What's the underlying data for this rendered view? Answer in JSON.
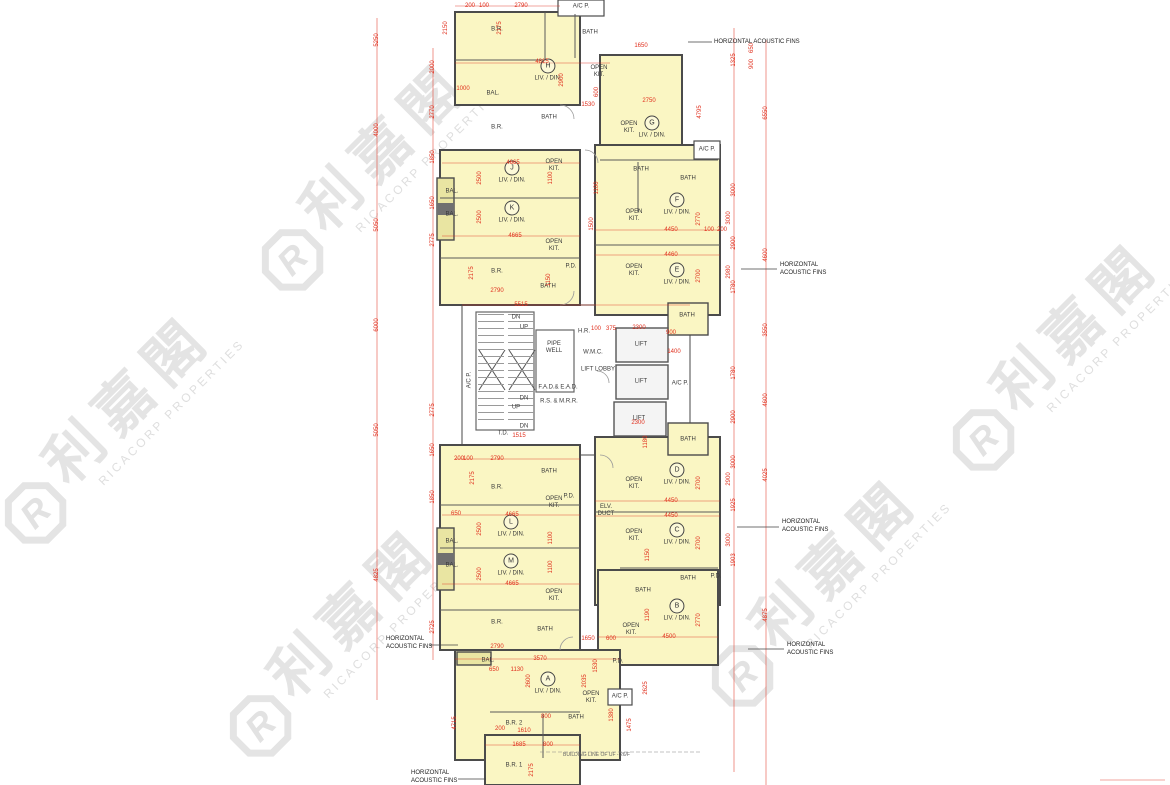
{
  "watermark": {
    "chinese": "利嘉閣",
    "latin": "RICACORP PROPERTIES",
    "logo_letter": "R",
    "color": "#E3E3E3",
    "instances": [
      {
        "x": 372,
        "y": 172
      },
      {
        "x": 1063,
        "y": 352
      },
      {
        "x": 115,
        "y": 425
      },
      {
        "x": 340,
        "y": 638
      },
      {
        "x": 822,
        "y": 588
      }
    ]
  },
  "plan": {
    "colors": {
      "unit_fill": "#FAF6C3",
      "balcony_fill": "#E9E5A2",
      "wall": "#4B4B4B",
      "dimension_red": "#E0301E",
      "watermark_gray": "#E3E3E3"
    },
    "unit_sub": "LIV. / DIN.",
    "acoustic_label": "HORIZONTAL ACOUSTIC FINS",
    "building_line_note": "BUILDING LINE OF UF - 26/F",
    "units": [
      {
        "id": "H",
        "x": 548,
        "y": 70
      },
      {
        "id": "G",
        "x": 652,
        "y": 127
      },
      {
        "id": "J",
        "x": 512,
        "y": 172
      },
      {
        "id": "K",
        "x": 512,
        "y": 212
      },
      {
        "id": "F",
        "x": 677,
        "y": 204
      },
      {
        "id": "E",
        "x": 677,
        "y": 274
      },
      {
        "id": "L",
        "x": 511,
        "y": 526
      },
      {
        "id": "M",
        "x": 511,
        "y": 565
      },
      {
        "id": "D",
        "x": 677,
        "y": 474
      },
      {
        "id": "C",
        "x": 677,
        "y": 534
      },
      {
        "id": "B",
        "x": 677,
        "y": 610
      },
      {
        "id": "A",
        "x": 548,
        "y": 683
      }
    ],
    "rooms": [
      {
        "t": "B.R.",
        "x": 497,
        "y": 30
      },
      {
        "t": "BATH",
        "x": 590,
        "y": 33
      },
      {
        "t": "A/C P.",
        "x": 581,
        "y": 7
      },
      {
        "t": "OPEN KIT.",
        "x": 599,
        "y": 72,
        "w": 24
      },
      {
        "t": "BAL.",
        "x": 493,
        "y": 94
      },
      {
        "t": "OPEN KIT.",
        "x": 629,
        "y": 128,
        "w": 24
      },
      {
        "t": "B.R.",
        "x": 497,
        "y": 128
      },
      {
        "t": "BATH",
        "x": 549,
        "y": 118
      },
      {
        "t": "BATH",
        "x": 641,
        "y": 170
      },
      {
        "t": "BATH",
        "x": 688,
        "y": 179
      },
      {
        "t": "A/C P.",
        "x": 707,
        "y": 150
      },
      {
        "t": "OPEN KIT.",
        "x": 554,
        "y": 166,
        "w": 24
      },
      {
        "t": "BAL.",
        "x": 452,
        "y": 192
      },
      {
        "t": "BAL.",
        "x": 452,
        "y": 215
      },
      {
        "t": "OPEN KIT.",
        "x": 554,
        "y": 246,
        "w": 24
      },
      {
        "t": "B.R.",
        "x": 497,
        "y": 272
      },
      {
        "t": "BATH",
        "x": 548,
        "y": 287
      },
      {
        "t": "P.D.",
        "x": 571,
        "y": 267
      },
      {
        "t": "OPEN KIT.",
        "x": 634,
        "y": 216,
        "w": 24
      },
      {
        "t": "OPEN KIT.",
        "x": 634,
        "y": 271,
        "w": 24
      },
      {
        "t": "BATH",
        "x": 687,
        "y": 316
      },
      {
        "t": "A/C P.",
        "x": 470,
        "y": 380,
        "r": 1
      },
      {
        "t": "DN",
        "x": 516,
        "y": 318
      },
      {
        "t": "UP",
        "x": 524,
        "y": 328
      },
      {
        "t": "PIPE WELL",
        "x": 554,
        "y": 348,
        "w": 26
      },
      {
        "t": "H.R.",
        "x": 584,
        "y": 332
      },
      {
        "t": "W.M.C.",
        "x": 593,
        "y": 353
      },
      {
        "t": "LIFT LOBBY",
        "x": 598,
        "y": 370
      },
      {
        "t": "F.A.D.& E.A.D.",
        "x": 558,
        "y": 388
      },
      {
        "t": "R.S. & M.R.R.",
        "x": 559,
        "y": 402
      },
      {
        "t": "DN",
        "x": 524,
        "y": 399
      },
      {
        "t": "UP",
        "x": 516,
        "y": 408
      },
      {
        "t": "DN",
        "x": 524,
        "y": 427
      },
      {
        "t": "T.D.",
        "x": 503,
        "y": 434
      },
      {
        "t": "LIFT",
        "x": 641,
        "y": 345
      },
      {
        "t": "LIFT",
        "x": 641,
        "y": 382
      },
      {
        "t": "LIFT",
        "x": 639,
        "y": 419
      },
      {
        "t": "A/C P.",
        "x": 680,
        "y": 384
      },
      {
        "t": "BATH",
        "x": 688,
        "y": 440
      },
      {
        "t": "OPEN KIT.",
        "x": 634,
        "y": 484,
        "w": 24
      },
      {
        "t": "ELV. DUCT",
        "x": 606,
        "y": 511,
        "w": 22
      },
      {
        "t": "B.R.",
        "x": 497,
        "y": 488
      },
      {
        "t": "BATH",
        "x": 549,
        "y": 472
      },
      {
        "t": "OPEN KIT.",
        "x": 554,
        "y": 503,
        "w": 24
      },
      {
        "t": "P.D.",
        "x": 569,
        "y": 497
      },
      {
        "t": "BAL.",
        "x": 452,
        "y": 542
      },
      {
        "t": "BAL.",
        "x": 452,
        "y": 566
      },
      {
        "t": "OPEN KIT.",
        "x": 554,
        "y": 596,
        "w": 24
      },
      {
        "t": "B.R.",
        "x": 497,
        "y": 623
      },
      {
        "t": "BATH",
        "x": 545,
        "y": 630
      },
      {
        "t": "OPEN KIT.",
        "x": 634,
        "y": 536,
        "w": 24
      },
      {
        "t": "BATH",
        "x": 688,
        "y": 579
      },
      {
        "t": "BATH",
        "x": 643,
        "y": 591
      },
      {
        "t": "P.D.",
        "x": 716,
        "y": 577
      },
      {
        "t": "OPEN KIT.",
        "x": 631,
        "y": 630,
        "w": 24
      },
      {
        "t": "P.D.",
        "x": 618,
        "y": 662
      },
      {
        "t": "BAL.",
        "x": 488,
        "y": 661
      },
      {
        "t": "OPEN KIT.",
        "x": 591,
        "y": 698,
        "w": 24
      },
      {
        "t": "A/C P.",
        "x": 620,
        "y": 697
      },
      {
        "t": "BATH",
        "x": 576,
        "y": 718
      },
      {
        "t": "B.R. 2",
        "x": 514,
        "y": 724
      },
      {
        "t": "B.R. 1",
        "x": 514,
        "y": 766
      }
    ],
    "annotations": [
      {
        "x": 714,
        "y": 39,
        "cls": "one"
      },
      {
        "x": 780,
        "y": 262
      },
      {
        "x": 782,
        "y": 519
      },
      {
        "x": 787,
        "y": 642
      },
      {
        "x": 386,
        "y": 636
      },
      {
        "x": 411,
        "y": 770
      }
    ],
    "dims": [
      {
        "t": "200",
        "x": 470,
        "y": 6
      },
      {
        "t": "100",
        "x": 484,
        "y": 6
      },
      {
        "t": "2790",
        "x": 521,
        "y": 6
      },
      {
        "t": "2150",
        "x": 446,
        "y": 28,
        "r": 1
      },
      {
        "t": "2175",
        "x": 500,
        "y": 28,
        "r": 1
      },
      {
        "t": "4815",
        "x": 542,
        "y": 62
      },
      {
        "t": "2900",
        "x": 562,
        "y": 80,
        "r": 1
      },
      {
        "t": "1000",
        "x": 463,
        "y": 89
      },
      {
        "t": "1530",
        "x": 588,
        "y": 105
      },
      {
        "t": "600",
        "x": 597,
        "y": 92,
        "r": 1
      },
      {
        "t": "1650",
        "x": 641,
        "y": 46
      },
      {
        "t": "2750",
        "x": 649,
        "y": 101
      },
      {
        "t": "4795",
        "x": 700,
        "y": 112,
        "r": 1
      },
      {
        "t": "4665",
        "x": 513,
        "y": 163
      },
      {
        "t": "2500",
        "x": 480,
        "y": 178,
        "r": 1
      },
      {
        "t": "1100",
        "x": 551,
        "y": 178,
        "r": 1
      },
      {
        "t": "4665",
        "x": 515,
        "y": 236
      },
      {
        "t": "2500",
        "x": 480,
        "y": 217,
        "r": 1
      },
      {
        "t": "1150",
        "x": 549,
        "y": 280,
        "r": 1
      },
      {
        "t": "2790",
        "x": 497,
        "y": 291
      },
      {
        "t": "2175",
        "x": 472,
        "y": 273,
        "r": 1
      },
      {
        "t": "4450",
        "x": 671,
        "y": 230
      },
      {
        "t": "100",
        "x": 709,
        "y": 230
      },
      {
        "t": "200",
        "x": 722,
        "y": 230
      },
      {
        "t": "2770",
        "x": 699,
        "y": 219,
        "r": 1
      },
      {
        "t": "3000",
        "x": 729,
        "y": 218,
        "r": 1
      },
      {
        "t": "4460",
        "x": 671,
        "y": 255
      },
      {
        "t": "2700",
        "x": 699,
        "y": 276,
        "r": 1
      },
      {
        "t": "2980",
        "x": 729,
        "y": 272,
        "r": 1
      },
      {
        "t": "1500",
        "x": 592,
        "y": 224,
        "r": 1
      },
      {
        "t": "1100",
        "x": 597,
        "y": 188,
        "r": 1
      },
      {
        "t": "5515",
        "x": 521,
        "y": 305
      },
      {
        "t": "2300",
        "x": 639,
        "y": 328
      },
      {
        "t": "375",
        "x": 611,
        "y": 329
      },
      {
        "t": "100",
        "x": 596,
        "y": 329
      },
      {
        "t": "1400",
        "x": 674,
        "y": 352
      },
      {
        "t": "2300",
        "x": 638,
        "y": 423
      },
      {
        "t": "1180",
        "x": 646,
        "y": 442,
        "r": 1
      },
      {
        "t": "1515",
        "x": 519,
        "y": 436
      },
      {
        "t": "900",
        "x": 671,
        "y": 333
      },
      {
        "t": "2790",
        "x": 497,
        "y": 459
      },
      {
        "t": "200",
        "x": 459,
        "y": 459
      },
      {
        "t": "100",
        "x": 468,
        "y": 459
      },
      {
        "t": "2175",
        "x": 473,
        "y": 478,
        "r": 1
      },
      {
        "t": "4665",
        "x": 512,
        "y": 515
      },
      {
        "t": "2500",
        "x": 480,
        "y": 529,
        "r": 1
      },
      {
        "t": "1100",
        "x": 551,
        "y": 538,
        "r": 1
      },
      {
        "t": "4665",
        "x": 512,
        "y": 584
      },
      {
        "t": "2500",
        "x": 480,
        "y": 574,
        "r": 1
      },
      {
        "t": "1100",
        "x": 551,
        "y": 567,
        "r": 1
      },
      {
        "t": "650",
        "x": 456,
        "y": 514
      },
      {
        "t": "2790",
        "x": 497,
        "y": 647
      },
      {
        "t": "4450",
        "x": 671,
        "y": 501
      },
      {
        "t": "2700",
        "x": 699,
        "y": 483,
        "r": 1
      },
      {
        "t": "2900",
        "x": 729,
        "y": 479,
        "r": 1
      },
      {
        "t": "4450",
        "x": 671,
        "y": 516
      },
      {
        "t": "2700",
        "x": 699,
        "y": 543,
        "r": 1
      },
      {
        "t": "3000",
        "x": 729,
        "y": 540,
        "r": 1
      },
      {
        "t": "1150",
        "x": 648,
        "y": 555,
        "r": 1
      },
      {
        "t": "4500",
        "x": 669,
        "y": 637
      },
      {
        "t": "2770",
        "x": 699,
        "y": 620,
        "r": 1
      },
      {
        "t": "1190",
        "x": 648,
        "y": 615,
        "r": 1
      },
      {
        "t": "1650",
        "x": 588,
        "y": 639
      },
      {
        "t": "600",
        "x": 611,
        "y": 639
      },
      {
        "t": "2035",
        "x": 585,
        "y": 681,
        "r": 1
      },
      {
        "t": "2625",
        "x": 646,
        "y": 688,
        "r": 1
      },
      {
        "t": "3570",
        "x": 540,
        "y": 659
      },
      {
        "t": "650",
        "x": 494,
        "y": 670
      },
      {
        "t": "1130",
        "x": 517,
        "y": 670
      },
      {
        "t": "2600",
        "x": 529,
        "y": 681,
        "r": 1
      },
      {
        "t": "1530",
        "x": 596,
        "y": 666,
        "r": 1
      },
      {
        "t": "800",
        "x": 546,
        "y": 717
      },
      {
        "t": "200",
        "x": 500,
        "y": 729
      },
      {
        "t": "1610",
        "x": 524,
        "y": 731
      },
      {
        "t": "1685",
        "x": 519,
        "y": 745
      },
      {
        "t": "800",
        "x": 548,
        "y": 745
      },
      {
        "t": "2175",
        "x": 532,
        "y": 770,
        "r": 1
      },
      {
        "t": "1380",
        "x": 612,
        "y": 715,
        "r": 1
      },
      {
        "t": "4715",
        "x": 455,
        "y": 723,
        "r": 1
      },
      {
        "t": "1475",
        "x": 630,
        "y": 725,
        "r": 1
      },
      {
        "t": "5250",
        "x": 377,
        "y": 40,
        "r": 1
      },
      {
        "t": "4000",
        "x": 377,
        "y": 130,
        "r": 1
      },
      {
        "t": "5050",
        "x": 377,
        "y": 225,
        "r": 1
      },
      {
        "t": "6000",
        "x": 377,
        "y": 325,
        "r": 1
      },
      {
        "t": "5050",
        "x": 377,
        "y": 430,
        "r": 1
      },
      {
        "t": "4825",
        "x": 377,
        "y": 575,
        "r": 1
      },
      {
        "t": "2000",
        "x": 433,
        "y": 67,
        "r": 1
      },
      {
        "t": "2770",
        "x": 433,
        "y": 112,
        "r": 1
      },
      {
        "t": "1850",
        "x": 433,
        "y": 157,
        "r": 1
      },
      {
        "t": "1650",
        "x": 433,
        "y": 203,
        "r": 1
      },
      {
        "t": "2775",
        "x": 433,
        "y": 240,
        "r": 1
      },
      {
        "t": "2775",
        "x": 433,
        "y": 410,
        "r": 1
      },
      {
        "t": "1650",
        "x": 433,
        "y": 450,
        "r": 1
      },
      {
        "t": "1850",
        "x": 433,
        "y": 497,
        "r": 1
      },
      {
        "t": "2725",
        "x": 433,
        "y": 627,
        "r": 1
      },
      {
        "t": "6550",
        "x": 766,
        "y": 113,
        "r": 1
      },
      {
        "t": "4600",
        "x": 766,
        "y": 255,
        "r": 1
      },
      {
        "t": "3550",
        "x": 766,
        "y": 330,
        "r": 1
      },
      {
        "t": "4600",
        "x": 766,
        "y": 400,
        "r": 1
      },
      {
        "t": "4025",
        "x": 766,
        "y": 475,
        "r": 1
      },
      {
        "t": "4875",
        "x": 766,
        "y": 615,
        "r": 1
      },
      {
        "t": "1325",
        "x": 734,
        "y": 60,
        "r": 1
      },
      {
        "t": "650",
        "x": 752,
        "y": 48,
        "r": 1
      },
      {
        "t": "900",
        "x": 752,
        "y": 64,
        "r": 1
      },
      {
        "t": "3000",
        "x": 734,
        "y": 190,
        "r": 1
      },
      {
        "t": "2900",
        "x": 734,
        "y": 243,
        "r": 1
      },
      {
        "t": "1780",
        "x": 734,
        "y": 287,
        "r": 1
      },
      {
        "t": "1780",
        "x": 734,
        "y": 373,
        "r": 1
      },
      {
        "t": "2900",
        "x": 734,
        "y": 417,
        "r": 1
      },
      {
        "t": "3000",
        "x": 734,
        "y": 462,
        "r": 1
      },
      {
        "t": "1925",
        "x": 734,
        "y": 505,
        "r": 1
      },
      {
        "t": "1903",
        "x": 734,
        "y": 560,
        "r": 1
      }
    ]
  }
}
